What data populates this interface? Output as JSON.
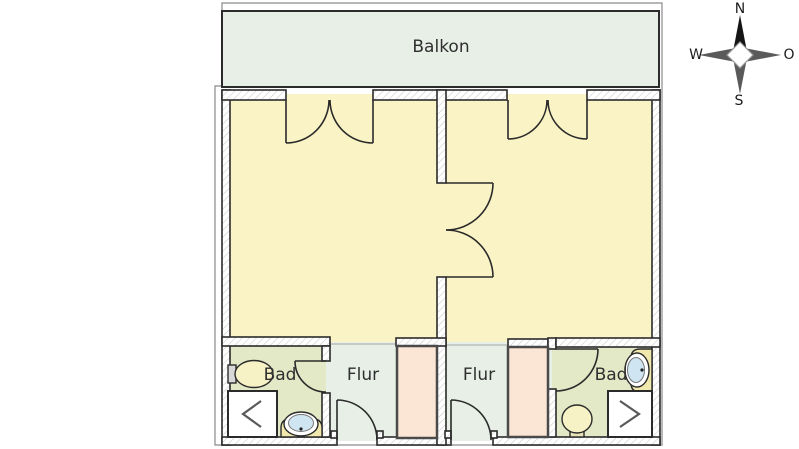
{
  "plan": {
    "rooms": {
      "balcony": {
        "label": "Balkon"
      },
      "bath_left": {
        "label": "Bad"
      },
      "hall_left": {
        "label": "Flur"
      },
      "hall_right": {
        "label": "Flur"
      },
      "bath_right": {
        "label": "Bad"
      }
    },
    "icons": {
      "bath_left": [
        "toilet-icon",
        "washbasin-icon",
        "shower-icon"
      ],
      "bath_right": [
        "toilet-icon",
        "washbasin-icon",
        "shower-icon"
      ],
      "hall_left": [
        "closet"
      ],
      "hall_right": [
        "closet"
      ],
      "doors": [
        "balcony-double-door-left",
        "balcony-double-door-right",
        "double-door-between-rooms",
        "hall-entry-door-left",
        "hall-entry-door-right",
        "bath-door-left",
        "bath-door-right"
      ]
    }
  },
  "compass": {
    "north": "N",
    "east": "O",
    "south": "S",
    "west": "W"
  },
  "colors": {
    "room": "#faf3c5",
    "balcony": "#e8efe7",
    "hall": "#e7efe7",
    "bath": "#e3e8c6",
    "closet": "#fbe5d4",
    "counter": "#f0e8ad",
    "fixture": "#f7f2c6",
    "basin": "#cfe5f1",
    "wall": "#2b2b2b",
    "compass_north": "#151515",
    "compass_other": "#5a5a5a"
  }
}
